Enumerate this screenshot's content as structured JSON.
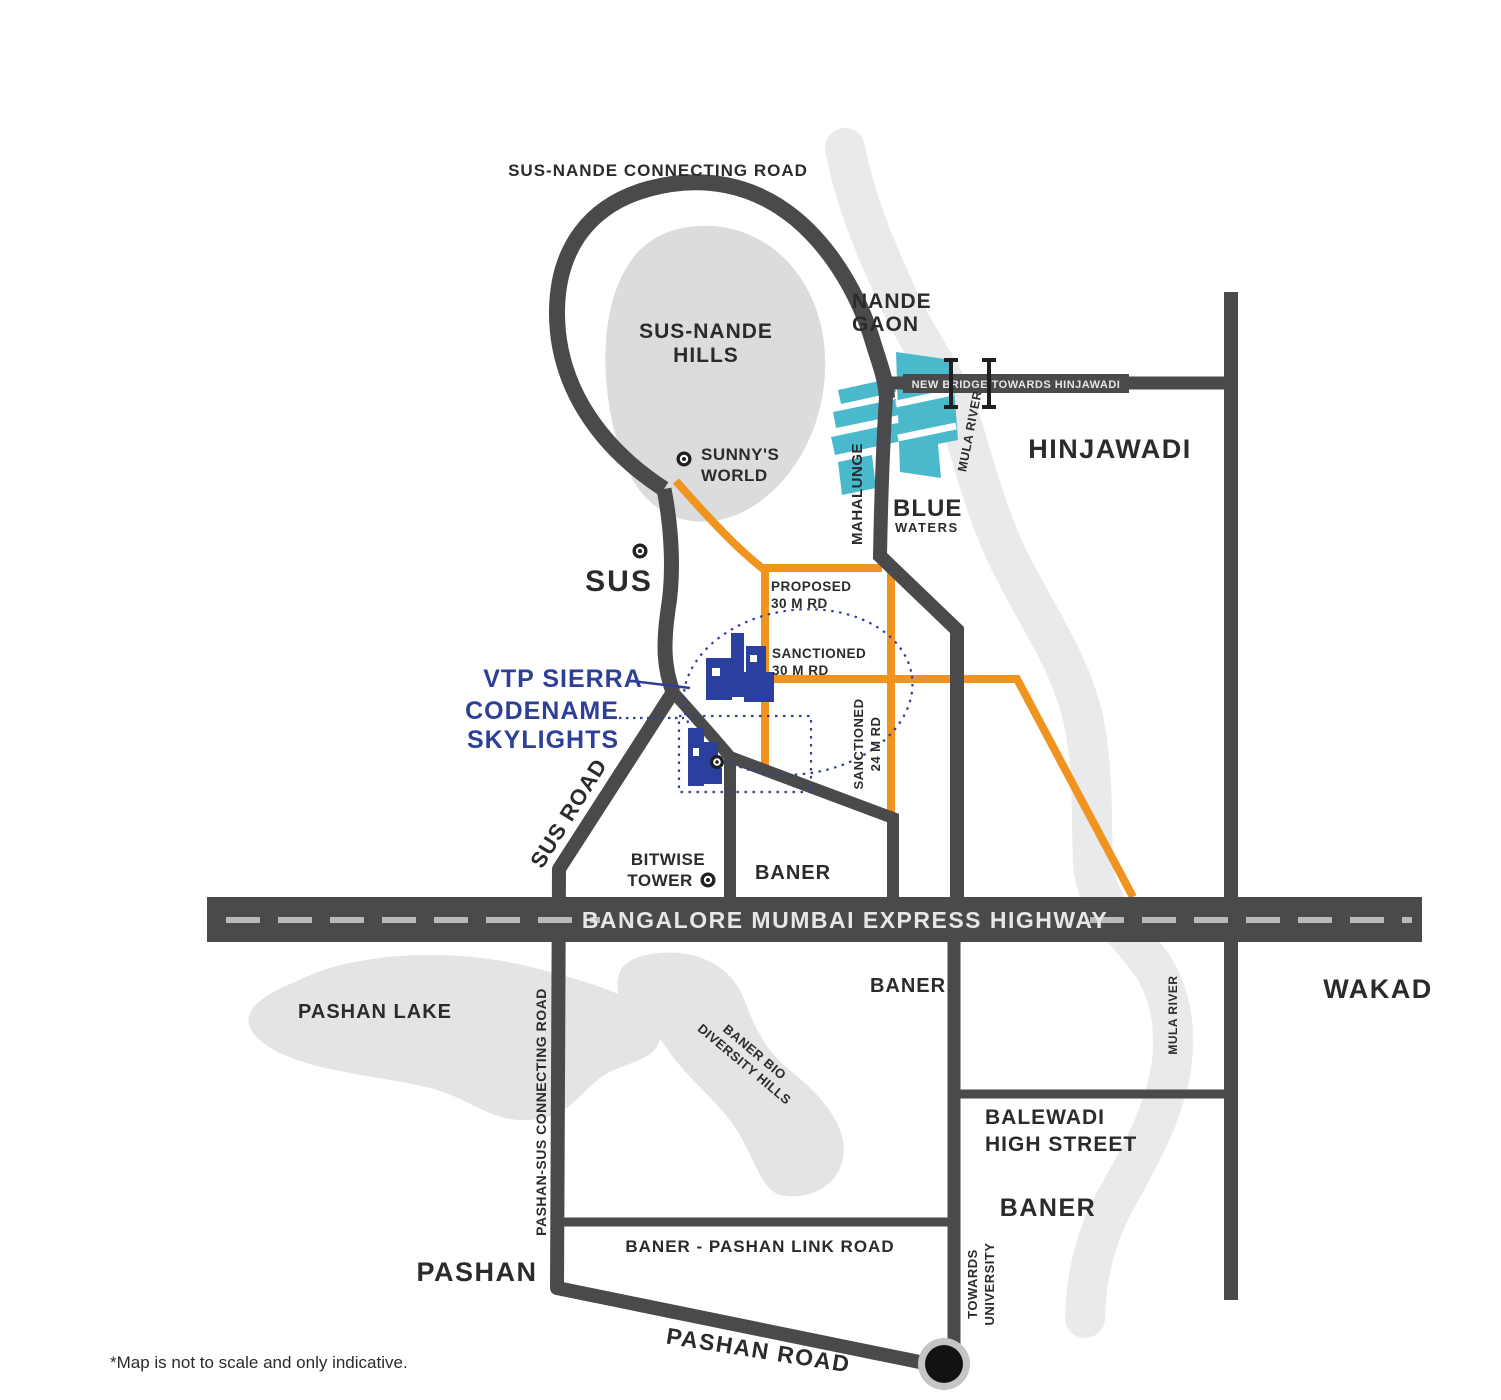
{
  "colors": {
    "road_dark": "#4A4A4D",
    "road_orange": "#F0931F",
    "project_navy": "#2E3F97",
    "blue_waters_cyan": "#4AB9CC",
    "terrain_gray": "#DCDDDE",
    "river_gray": "#E9EAEB",
    "highway_text": "#E6E6E8",
    "label_dark": "#2B2B2D"
  },
  "labels": {
    "sus_nande_connecting_road": "SUS-NANDE CONNECTING ROAD",
    "sus_nande_hills_line1": "SUS-NANDE",
    "sus_nande_hills_line2": "HILLS",
    "nande_gaon_line1": "NANDE",
    "nande_gaon_line2": "GAON",
    "new_bridge": "NEW BRIDGE TOWARDS HINJAWADI",
    "hinjawadi": "HINJAWADI",
    "mula_river_upper": "MULA RIVER",
    "blue_waters_line1": "BLUE",
    "blue_waters_line2": "WATERS",
    "mahalunge": "MAHALUNGE",
    "sunnys_world_line1": "SUNNY'S",
    "sunnys_world_line2": "WORLD",
    "sus": "SUS",
    "proposed_30m_line1": "PROPOSED",
    "proposed_30m_line2": "30 M RD",
    "sanctioned_30m_line1": "SANCTIONED",
    "sanctioned_30m_line2": "30 M RD",
    "sanctioned_24m_line1": "SANCTIONED",
    "sanctioned_24m_line2": "24 M RD",
    "vtp_sierra": "VTP SIERRA",
    "codename_line1": "CODENAME",
    "codename_line2": "SKYLIGHTS",
    "sus_road": "SUS ROAD",
    "bitwise_tower_line1": "BITWISE",
    "bitwise_tower_line2": "TOWER",
    "baner_above_highway": "BANER",
    "highway": "BANGALORE MUMBAI EXPRESS HIGHWAY",
    "baner_below_highway": "BANER",
    "wakad": "WAKAD",
    "pashan_lake": "PASHAN LAKE",
    "pashan_sus_connecting_road": "PASHAN-SUS CONNECTING ROAD",
    "baner_bio_line1": "BANER BIO",
    "baner_bio_line2": "DIVERSITY HILLS",
    "balewadi_line1": "BALEWADI",
    "balewadi_line2": "HIGH STREET",
    "baner_area": "BANER",
    "mula_river_lower": "MULA RIVER",
    "baner_pashan_link_road": "BANER - PASHAN LINK ROAD",
    "pashan": "PASHAN",
    "pashan_road": "PASHAN ROAD",
    "towards_university_line1": "TOWARDS",
    "towards_university_line2": "UNIVERSITY"
  },
  "footnote": "*Map is not to scale and only indicative."
}
